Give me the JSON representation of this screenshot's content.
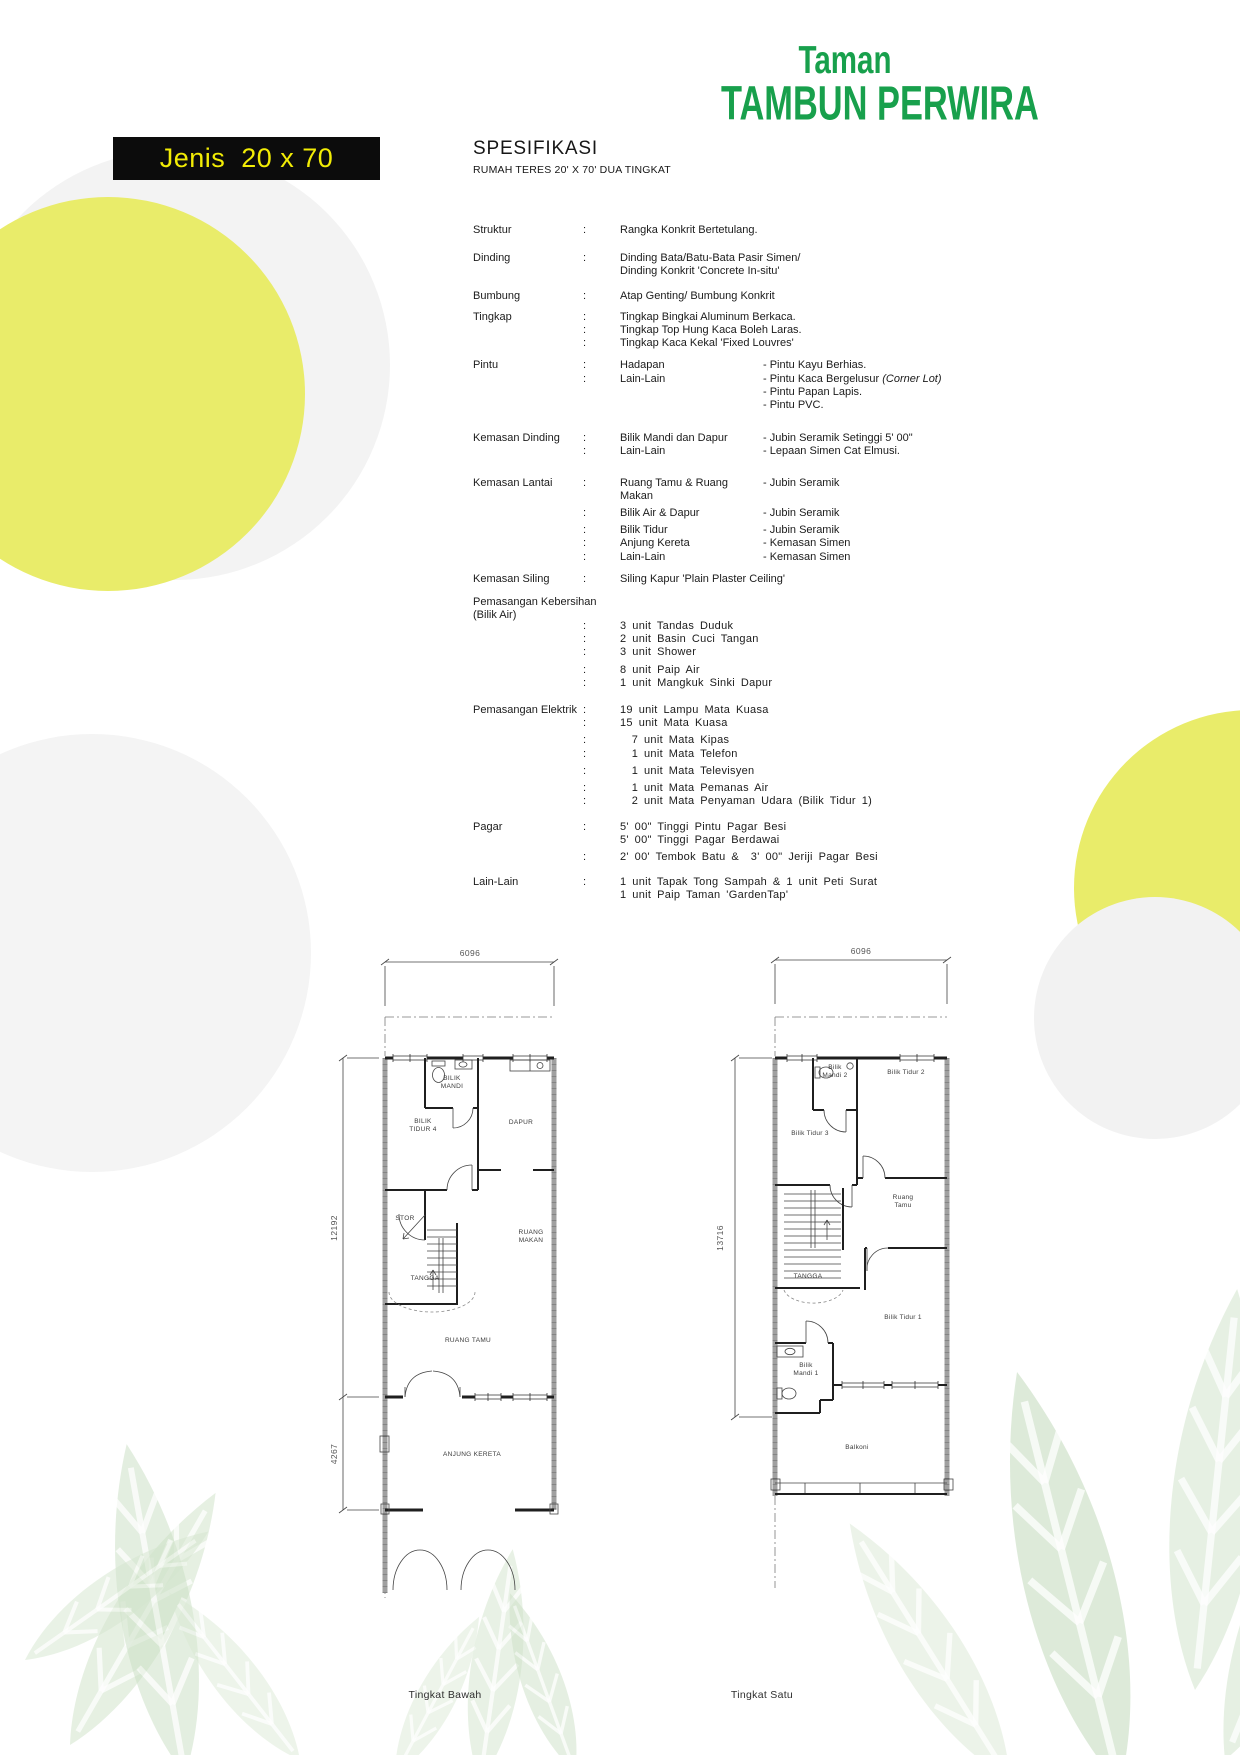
{
  "header": {
    "logo_line1": "Taman",
    "logo_line2": "TAMBUN PERWIRA",
    "type_label": "Jenis  20 x 70",
    "spec_title": "SPESIFIKASI",
    "spec_subtitle": "RUMAH TERES 20' X 70' DUA TINGKAT"
  },
  "colors": {
    "brand_green": "#18a04c",
    "type_box_bg": "#0c0c0c",
    "type_box_text": "#f2ec05",
    "circle_yellow": "#e9ec6a",
    "circle_gray": "#f3f3f3",
    "leaf_green": "#cfe2cb"
  },
  "spec_sections": [
    {
      "label": "Struktur",
      "lines": [
        {
          "colon": ":",
          "c1": "Rangka Konkrit Bertetulang."
        }
      ]
    },
    {
      "label": "Dinding",
      "lines": [
        {
          "colon": ":",
          "c1": "Dinding Bata/Batu-Bata Pasir Simen/"
        },
        {
          "colon": "",
          "c1": "Dinding Konkrit 'Concrete In-situ'"
        }
      ]
    },
    {
      "label": "Bumbung",
      "lines": [
        {
          "colon": ":",
          "c1": "Atap Genting/ Bumbung Konkrit"
        }
      ]
    },
    {
      "label": "Tingkap",
      "lines": [
        {
          "colon": ":",
          "c1": "Tingkap Bingkai Aluminum Berkaca."
        },
        {
          "colon": ":",
          "c1": "Tingkap Top Hung Kaca Boleh Laras."
        },
        {
          "colon": ":",
          "c1": "Tingkap Kaca Kekal 'Fixed Louvres'"
        }
      ]
    },
    {
      "label": "Pintu",
      "lines": [
        {
          "colon": ":",
          "c1": "Hadapan",
          "c2": "- Pintu Kayu Berhias."
        },
        {
          "colon": ":",
          "c1": "Lain-Lain",
          "c2": "- Pintu Kaca Bergelusur",
          "c2i": "(Corner Lot)"
        },
        {
          "colon": "",
          "c1": "",
          "c2": "- Pintu Papan Lapis."
        },
        {
          "colon": "",
          "c1": "",
          "c2": "- Pintu PVC."
        }
      ]
    },
    {
      "label": "Kemasan Dinding",
      "lines": [
        {
          "colon": ":",
          "c1": "Bilik Mandi dan Dapur",
          "c2": "- Jubin Seramik Setinggi 5' 00\""
        },
        {
          "colon": ":",
          "c1": "Lain-Lain",
          "c2": "- Lepaan Simen Cat Elmusi."
        }
      ]
    },
    {
      "label": "Kemasan Lantai",
      "lines": [
        {
          "colon": ":",
          "c1": "Ruang Tamu & Ruang Makan",
          "c2": "- Jubin Seramik"
        },
        {
          "colon": ":",
          "c1": "Bilik Air & Dapur",
          "c2": "- Jubin Seramik",
          "gap": true
        },
        {
          "colon": ":",
          "c1": "Bilik Tidur",
          "c2": "- Jubin Seramik",
          "gap": true
        },
        {
          "colon": ":",
          "c1": "Anjung Kereta",
          "c2": "- Kemasan Simen"
        },
        {
          "colon": ":",
          "c1": "Lain-Lain",
          "c2": "- Kemasan Simen"
        }
      ]
    },
    {
      "label": "Kemasan Siling",
      "lines": [
        {
          "colon": ":",
          "c1": "Siling Kapur 'Plain Plaster Ceiling'"
        }
      ]
    },
    {
      "label": "Pemasangan Kebersihan",
      "label2": "(Bilik Air)",
      "lines": [
        {
          "colon": ":",
          "c1": "3 unit Tandas Duduk"
        },
        {
          "colon": ":",
          "c1": "2 unit Basin Cuci Tangan"
        },
        {
          "colon": ":",
          "c1": "3 unit Shower"
        },
        {
          "colon": ":",
          "c1": "8 unit Paip Air",
          "gap": true
        },
        {
          "colon": ":",
          "c1": "1 unit Mangkuk Sinki Dapur"
        }
      ]
    },
    {
      "label": "Pemasangan Elektrik",
      "lines": [
        {
          "colon": ":",
          "c1": "19 unit Lampu Mata Kuasa"
        },
        {
          "colon": ":",
          "c1": "15 unit Mata Kuasa"
        },
        {
          "colon": ":",
          "c1": "  7 unit Mata Kipas",
          "gap": true
        },
        {
          "colon": ":",
          "c1": "  1 unit Mata Telefon"
        },
        {
          "colon": ":",
          "c1": "  1 unit Mata Televisyen",
          "gap": true
        },
        {
          "colon": ":",
          "c1": "  1 unit Mata Pemanas Air",
          "gap": true
        },
        {
          "colon": ":",
          "c1": "  2 unit Mata Penyaman Udara (Bilik Tidur 1)"
        }
      ]
    },
    {
      "label": "Pagar",
      "lines": [
        {
          "colon": ":",
          "c1": "5' 00\" Tinggi Pintu Pagar Besi"
        },
        {
          "colon": "",
          "c1": "5' 00\" Tinggi Pagar Berdawai"
        },
        {
          "colon": ":",
          "c1": "2' 00' Tembok Batu &  3' 00\" Jeriji Pagar Besi",
          "gap": true
        }
      ]
    },
    {
      "label": "Lain-Lain",
      "lines": [
        {
          "colon": ":",
          "c1": "1 unit Tapak Tong Sampah & 1 unit Peti Surat"
        },
        {
          "colon": "",
          "c1": "1 unit Paip Taman 'GardenTap'"
        }
      ]
    }
  ],
  "plans": [
    {
      "caption": "Tingkat Bawah",
      "dim_width": "6096",
      "dim_depth_main": "12192",
      "dim_depth_porch": "4267",
      "rooms": {
        "bilik_mandi": "BILIK MANDI",
        "bilik_tidur4": "BILIK TIDUR 4",
        "dapur": "DAPUR",
        "stor": "STOR",
        "tangga": "TANGGA",
        "ruang_makan": "RUANG MAKAN",
        "ruang_tamu": "RUANG TAMU",
        "anjung_kereta": "ANJUNG KERETA"
      }
    },
    {
      "caption": "Tingkat Satu",
      "dim_width": "6096",
      "dim_depth_main": "13716",
      "rooms": {
        "bilik_mandi2": "Bilik Mandi 2",
        "bilik_tidur2": "Bilik Tidur 2",
        "bilik_tidur3": "Bilik Tidur 3",
        "ruang_tamu": "Ruang Tamu",
        "tangga": "TANGGA",
        "bilik_tidur1": "Bilik Tidur 1",
        "bilik_mandi1": "Bilik Mandi 1",
        "balkoni": "Balkoni"
      }
    }
  ]
}
